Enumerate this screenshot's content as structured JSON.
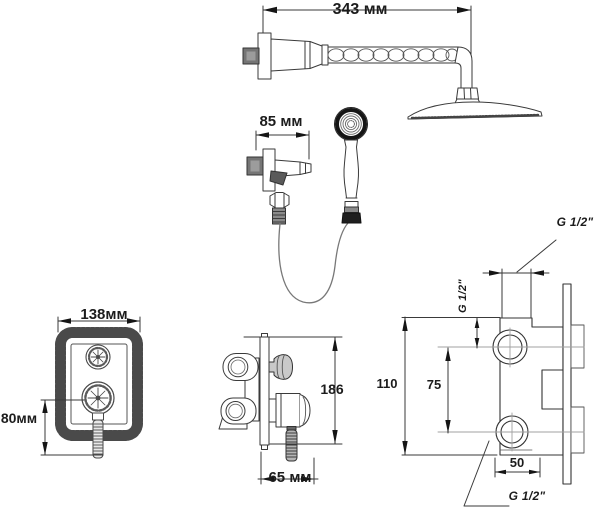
{
  "diagram": {
    "type": "shower-set-installation-drawing",
    "units": "mm",
    "labels": {
      "arm_length": "343 мм",
      "holder_width": "85 мм",
      "plate_width": "138мм",
      "plate_height": "80мм",
      "mixer_height": "186",
      "mixer_depth": "65 мм",
      "body_height": "110",
      "port_spacing": "75",
      "port_width": "50",
      "thread_top": "G 1/2\"",
      "thread_side": "G 1/2\"",
      "thread_bottom": "G 1/2\""
    },
    "colors": {
      "line": "#3a3a3a",
      "arrow": "#151515",
      "centerline": "#a0a0a0",
      "metal_dark": "#757575",
      "text": "#1c1c1c",
      "background": "#ffffff"
    }
  }
}
